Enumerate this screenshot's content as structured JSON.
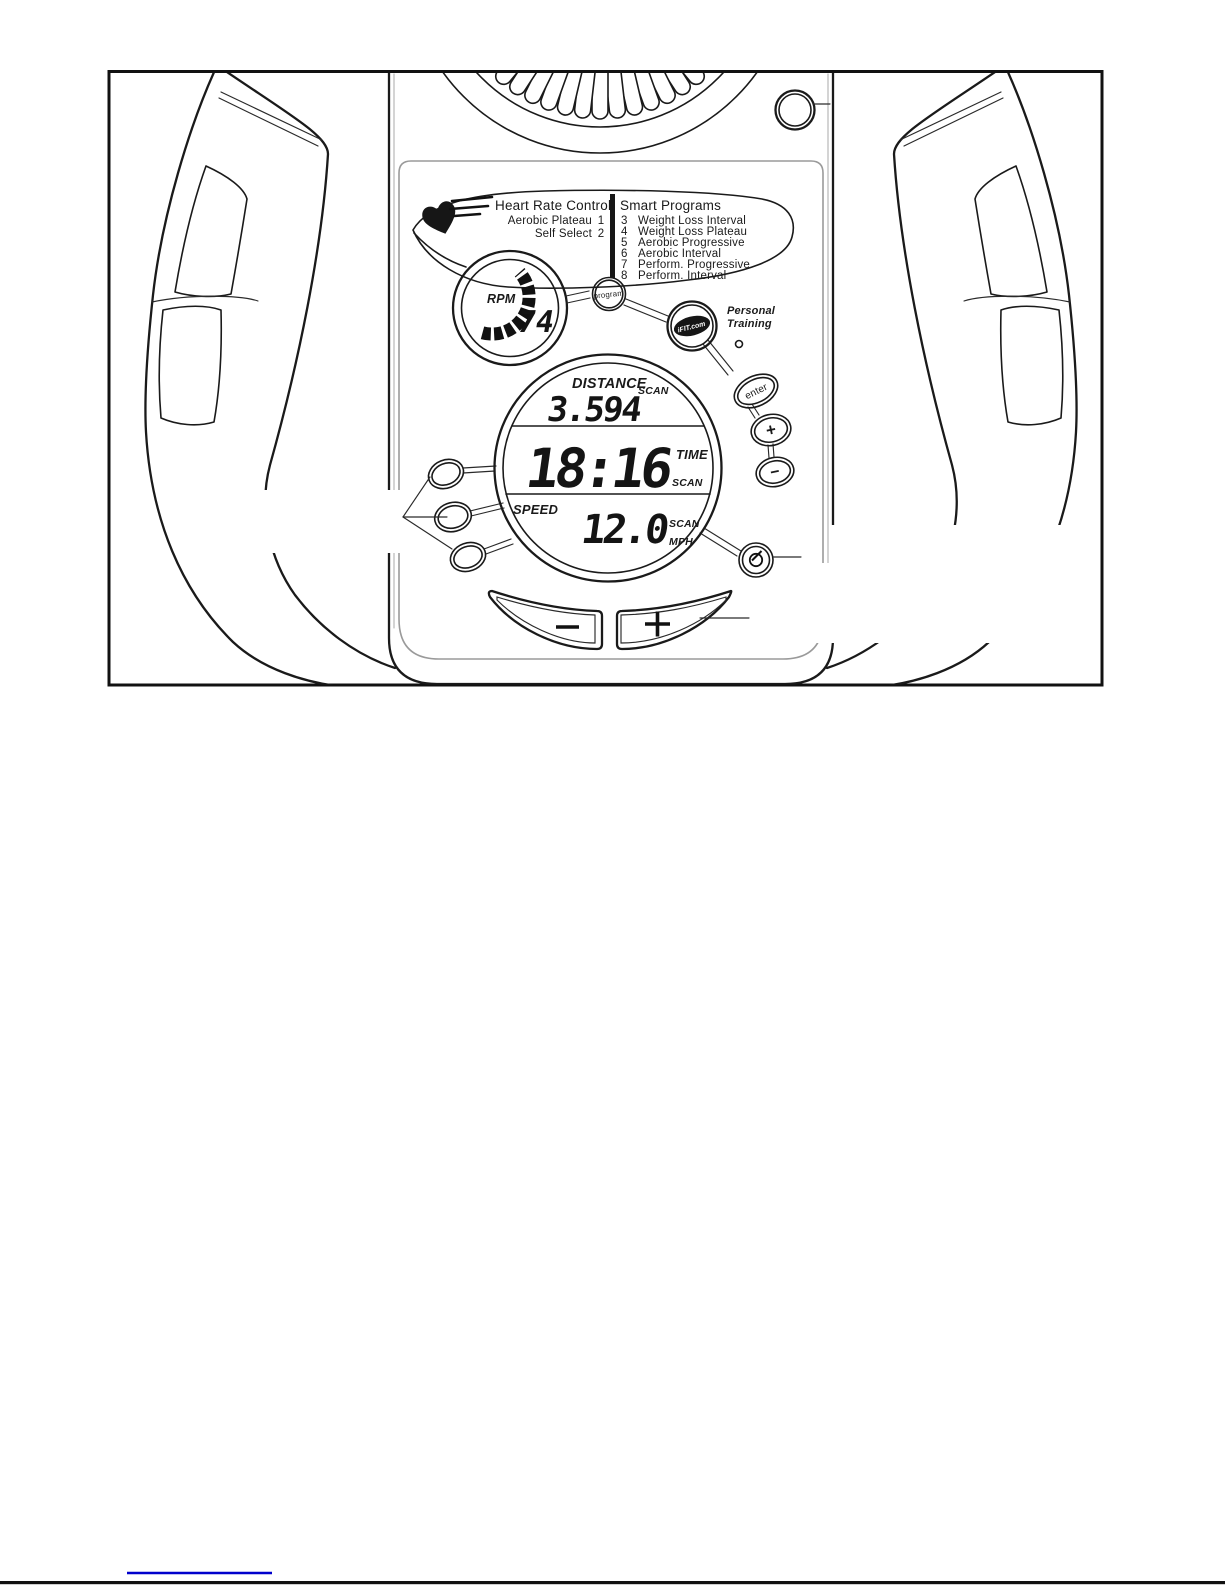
{
  "colors": {
    "ink": "#1a1a1a",
    "shadow_gray": "#b5b5b5",
    "panel_outline": "#9a9a9a",
    "link_underline": "#0000cc"
  },
  "console": {
    "heart_rate_control": {
      "title": "Heart Rate Control",
      "options": [
        {
          "label": "Aerobic Plateau",
          "number": "1"
        },
        {
          "label": "Self Select",
          "number": "2"
        }
      ]
    },
    "smart_programs": {
      "title": "Smart Programs",
      "options": [
        {
          "number": "3",
          "label": "Weight Loss Interval"
        },
        {
          "number": "4",
          "label": "Weight Loss Plateau"
        },
        {
          "number": "5",
          "label": "Aerobic Progressive"
        },
        {
          "number": "6",
          "label": "Aerobic Interval"
        },
        {
          "number": "7",
          "label": "Perform. Progressive"
        },
        {
          "number": "8",
          "label": "Perform. Interval"
        }
      ]
    },
    "rpm_gauge": {
      "label": "RPM",
      "value": "74"
    },
    "program_button": "program",
    "ifit": {
      "logo": "iFIT.com",
      "tagline": [
        "Personal",
        "Training"
      ]
    },
    "enter_button": "enter",
    "increase_button": "+",
    "decrease_button": "−",
    "display": {
      "distance": {
        "label": "DISTANCE",
        "mode": "SCAN",
        "value": "3.594"
      },
      "time": {
        "value": "18:16",
        "label": "TIME",
        "mode": "SCAN"
      },
      "speed": {
        "label": "SPEED",
        "value": "12.0",
        "mode": "SCAN",
        "unit": "MPH"
      }
    },
    "resistance_minus_button": "−",
    "resistance_plus_button": "+",
    "icons": {
      "heart": "heart-icon",
      "clock": "clock-reset-icon",
      "speaker": "speaker-grille",
      "ifit_logo": "ifit-logo"
    }
  }
}
